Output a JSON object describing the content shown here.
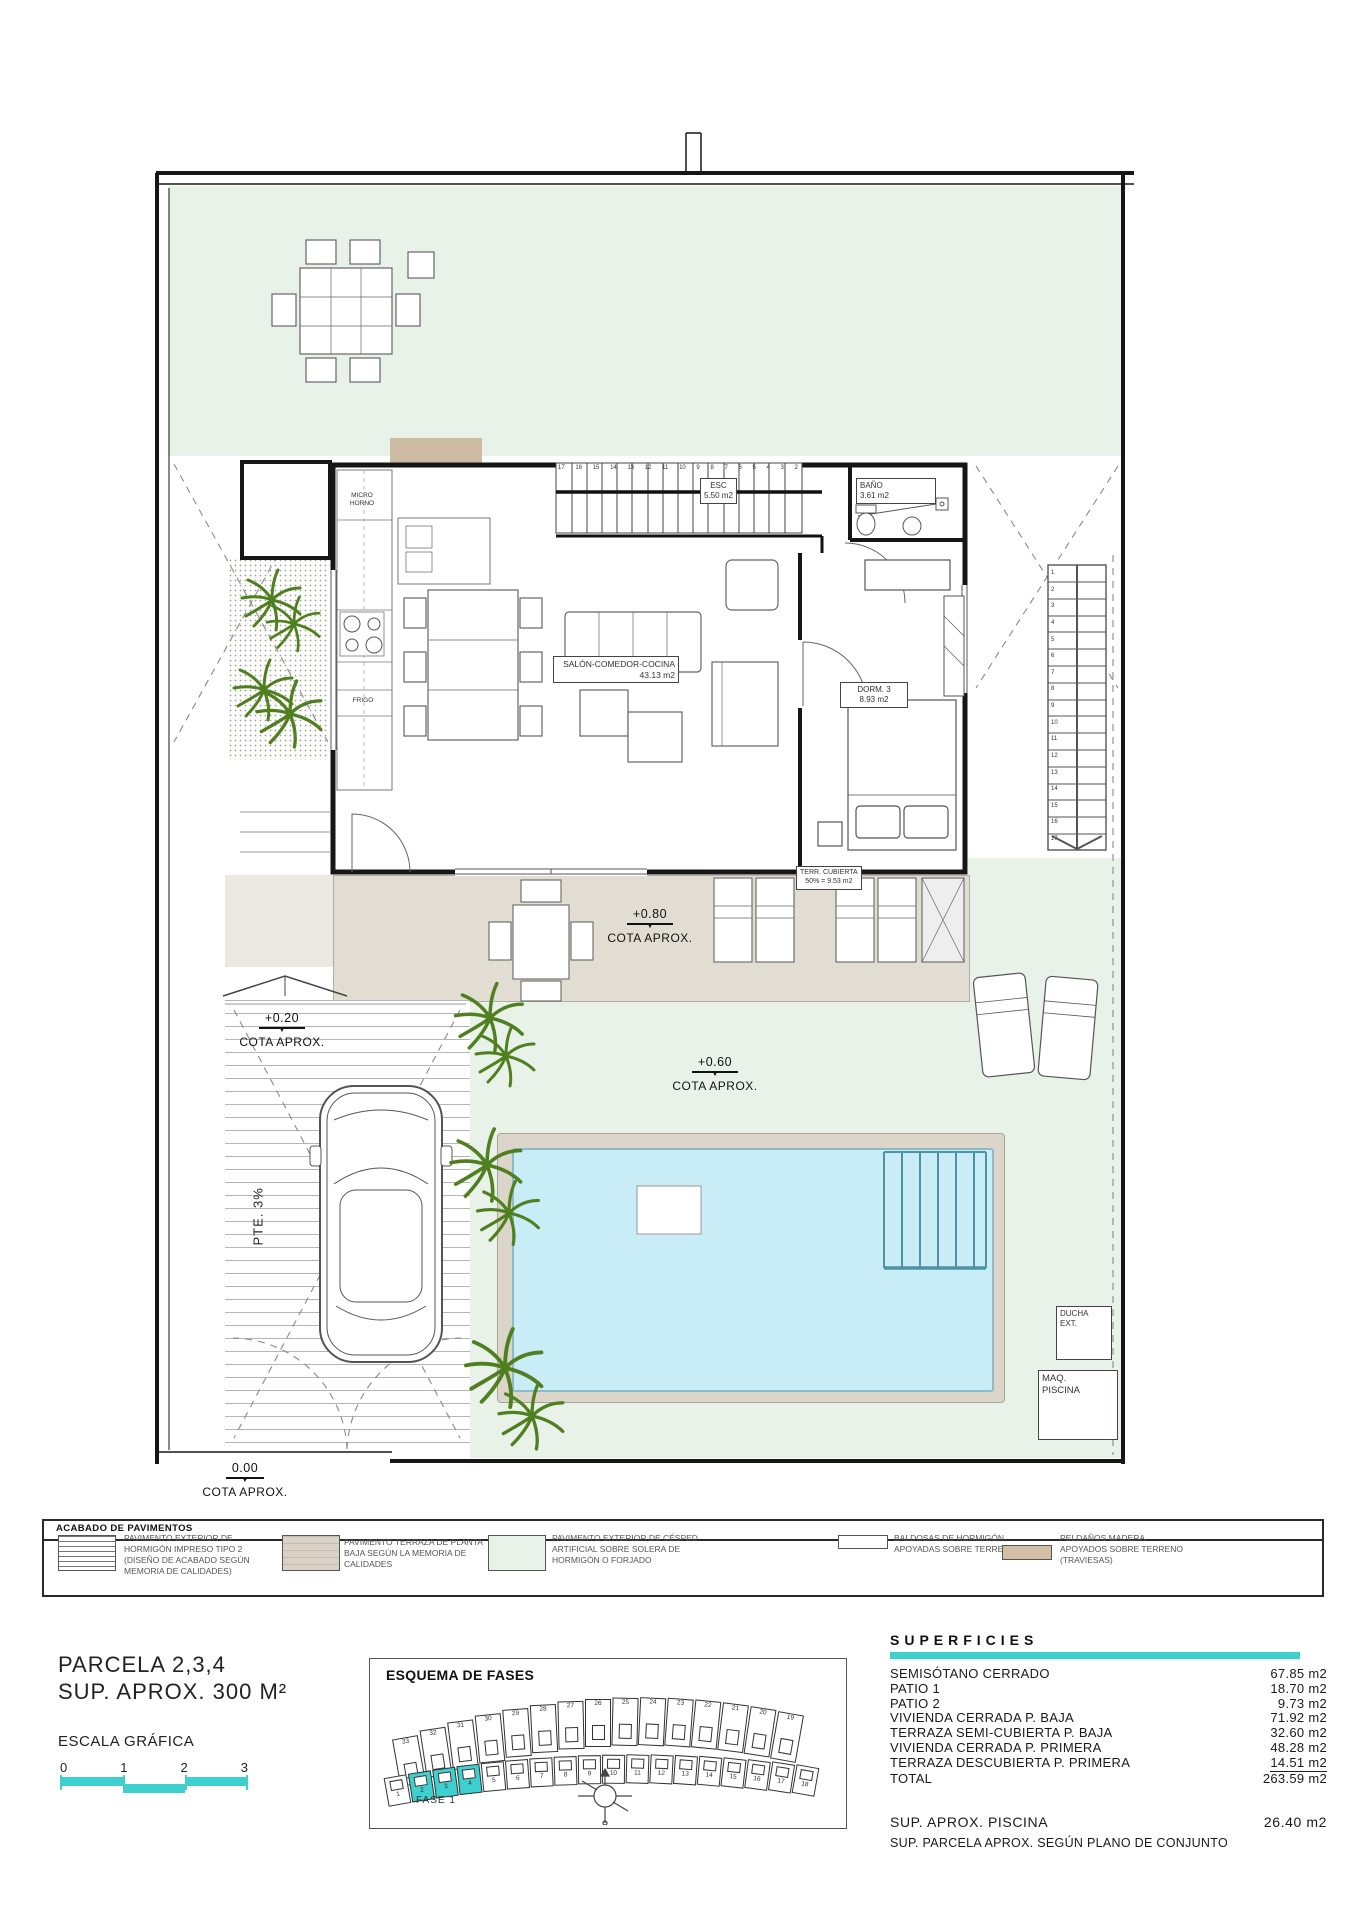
{
  "colors": {
    "accent": "#3ECFCF",
    "grass": "#E8F2E9",
    "terrace": "#E2DDD2",
    "pool_water": "#C9EDF7",
    "pool_line": "#4E93A5",
    "tan": "#D2BFA5",
    "plant_green": "#4F7F1F"
  },
  "plan": {
    "rooms": {
      "salon": {
        "line1": "SALÓN-COMEDOR-COCINA",
        "line2": "43.13 m2"
      },
      "dorm3": {
        "line1": "DORM. 3",
        "line2": "8.93 m2"
      },
      "bano": {
        "line1": "BAÑO",
        "line2": "3.61 m2"
      },
      "esc": {
        "line1": "ESC",
        "line2": "5.50 m2"
      },
      "terraza_cubierta": {
        "line1": "TERR. CUBIERTA",
        "line2": "50% = 9.53 m2"
      }
    },
    "equipment": {
      "micro": {
        "line1": "MICRO",
        "line2": "HORNO"
      },
      "frigo": "FRIGO",
      "ducha": {
        "line1": "DUCHA",
        "line2": "EXT."
      },
      "maq": {
        "line1": "MAQ.",
        "line2": "PISCINA"
      }
    },
    "cotas": {
      "terraza": {
        "value": "+0.80",
        "label": "COTA APROX."
      },
      "acceso": {
        "value": "+0.20",
        "label": "COTA APROX."
      },
      "jardin": {
        "value": "+0.60",
        "label": "COTA APROX."
      },
      "calle": {
        "value": "0.00",
        "label": "COTA APROX."
      }
    },
    "pendiente": "PTE. 3%",
    "stair_interior_numbers": [
      "17",
      "16",
      "15",
      "14",
      "13",
      "12",
      "11",
      "10",
      "9",
      "8",
      "7",
      "6",
      "5",
      "4",
      "3",
      "2"
    ],
    "stair_exterior_numbers": [
      "1",
      "2",
      "3",
      "4",
      "5",
      "6",
      "7",
      "8",
      "9",
      "10",
      "11",
      "12",
      "13",
      "14",
      "15",
      "16",
      "17"
    ]
  },
  "legend": {
    "title": "ACABADO DE PAVIMENTOS",
    "items": [
      {
        "swatch": "hatch",
        "text": "PAVIMENTO EXTERIOR DE HORMIGÓN IMPRESO  TIPO 2 (DISEÑO DE ACABADO SEGÚN MEMORIA DE CALIDADES)"
      },
      {
        "swatch": "beige",
        "text": "PAVIMENTO TERRAZA DE PLANTA BAJA SEGÚN LA MEMORIA DE CALIDADES"
      },
      {
        "swatch": "grass",
        "text": "PAVIMENTO EXTERIOR DE CÉSPED ARTIFICIAL SOBRE SOLERA DE HORMIGÓN O FORJADO"
      },
      {
        "swatch": "white",
        "text": "BALDOSAS DE HORMIGÓN APOYADAS SOBRE TERRENO"
      },
      {
        "swatch": "tan",
        "text": "PELDAÑOS MADERA APOYADOS SOBRE TERRENO (TRAVIESAS)"
      }
    ]
  },
  "footer": {
    "parcela": {
      "line1": "PARCELA 2,3,4",
      "line2": "SUP. APROX. 300 M²"
    },
    "escala": {
      "title": "ESCALA GRÁFICA",
      "ticks": [
        "0",
        "1",
        "2",
        "3"
      ]
    },
    "esquema": {
      "title": "ESQUEMA DE FASES",
      "fase": "FASE 1",
      "top_row": [
        "33",
        "32",
        "31",
        "30",
        "29",
        "28",
        "27",
        "26",
        "25",
        "24",
        "23",
        "22",
        "21",
        "20",
        "19"
      ],
      "bottom_row": [
        "1",
        "2",
        "3",
        "4",
        "5",
        "6",
        "7",
        "8",
        "9",
        "10",
        "11",
        "12",
        "13",
        "14",
        "15",
        "16",
        "17",
        "18"
      ],
      "highlighted": [
        "2",
        "3",
        "4"
      ]
    },
    "superficies": {
      "title": "SUPERFICIES",
      "rows": [
        {
          "label": "SEMISÓTANO CERRADO",
          "value": "67.85 m2"
        },
        {
          "label": "PATIO  1",
          "value": "18.70 m2"
        },
        {
          "label": "PATIO 2",
          "value": "9.73 m2"
        },
        {
          "label": "VIVIENDA CERRADA P. BAJA",
          "value": "71.92 m2"
        },
        {
          "label": "TERRAZA SEMI-CUBIERTA P. BAJA",
          "value": "32.60 m2"
        },
        {
          "label": "VIVIENDA CERRADA P. PRIMERA",
          "value": "48.28 m2"
        },
        {
          "label": "TERRAZA DESCUBIERTA P. PRIMERA",
          "value": "14.51 m2"
        },
        {
          "label": "TOTAL",
          "value": "263.59 m2"
        }
      ],
      "piscina": {
        "label": "SUP.  APROX.  PISCINA",
        "value": "26.40 m2"
      },
      "note": "SUP. PARCELA APROX. SEGÚN PLANO DE CONJUNTO"
    }
  }
}
